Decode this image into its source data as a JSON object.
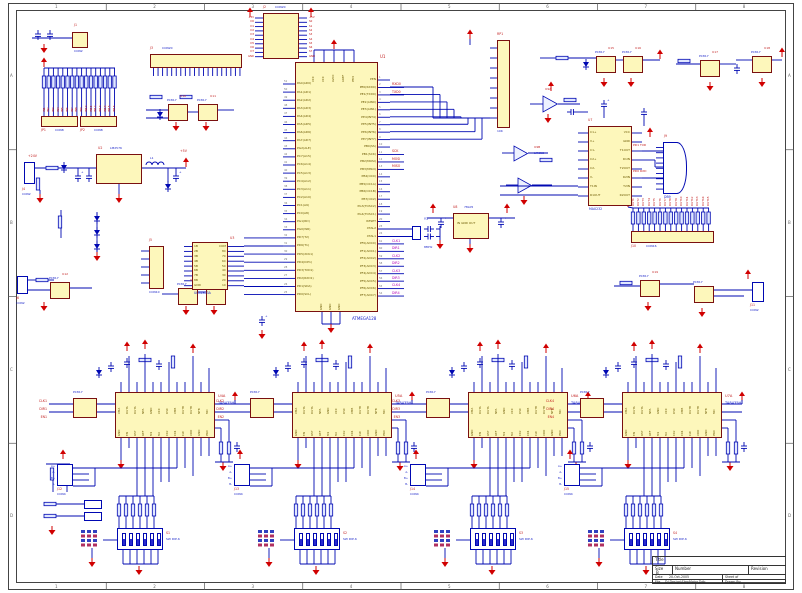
{
  "sheet": {
    "zones_top": [
      "1",
      "2",
      "3",
      "4",
      "5",
      "6",
      "7",
      "8"
    ],
    "zones_side": [
      "A",
      "B",
      "C",
      "D"
    ]
  },
  "colors": {
    "wire": "#0008b2",
    "ic_fill": "#fdf7bb",
    "ic_border": "#7a1010",
    "power": "#d00000",
    "net": "#c01818",
    "net_alt": "#b400b4",
    "part_text": "#1822c8",
    "designator": "#c22020"
  },
  "title_block": {
    "title_label": "Title",
    "size_label": "Size",
    "size_value": "B",
    "number_label": "Number",
    "revision_label": "Revision",
    "date_label": "Date",
    "date_value": "20-Oct-2005",
    "sheet_label": "Sheet of",
    "file_label": "File",
    "file_value": "D:\\Design\\StepMotor.Ddb",
    "drawn_label": "Drawn By:"
  },
  "mcu": {
    "designator": "U1",
    "part": "ATMEGA128",
    "left_pins": [
      "PA0(AD0)",
      "PA1(AD1)",
      "PA2(AD2)",
      "PA3(AD3)",
      "PA4(AD4)",
      "PA5(AD5)",
      "PA6(AD6)",
      "PA7(AD7)",
      "PG2(ALE)",
      "PC7(A15)",
      "PC6(A14)",
      "PC5(A13)",
      "PC4(A12)",
      "PC3(A11)",
      "PC2(A10)",
      "PC1(A9)",
      "PC0(A8)",
      "PG1(RD)",
      "PG0(WR)",
      "PD7(T2)",
      "PD6(T1)",
      "PD5(XCK1)",
      "PD4(ICP1)",
      "PD3(TXD1)",
      "PD2(RXD1)",
      "PD1(SDA)",
      "PD0(SCL)"
    ],
    "left_nums": [
      51,
      50,
      49,
      48,
      47,
      46,
      45,
      44,
      43,
      42,
      41,
      40,
      39,
      38,
      37,
      36,
      35,
      34,
      33,
      32,
      31,
      30,
      29,
      28,
      27,
      26,
      25
    ],
    "right_pins": [
      "PEN",
      "PE0(RXD0)",
      "PE1(TXD0)",
      "PE2(AIN0)",
      "PE3(AIN1)",
      "PE4(INT4)",
      "PE5(INT5)",
      "PE6(INT6)",
      "PE7(INT7)",
      "PB0(SS)",
      "PB1(SCK)",
      "PB2(MOSI)",
      "PB3(MISO)",
      "PB4(OC0)",
      "PB5(OC1A)",
      "PB6(OC1B)",
      "PB7(OC2)",
      "PG3(TOSC2)",
      "PG4(TOSC1)",
      "RESET",
      "XTAL2",
      "XTAL1",
      "PF0(ADC0)",
      "PF1(ADC1)",
      "PF2(ADC2)",
      "PF3(ADC3)",
      "PF4(ADC4)",
      "PF5(ADC5)",
      "PF6(ADC6)",
      "PF7(ADC7)"
    ],
    "right_nums": [
      1,
      2,
      3,
      4,
      5,
      6,
      7,
      8,
      9,
      10,
      11,
      12,
      13,
      14,
      15,
      16,
      17,
      18,
      19,
      20,
      23,
      24,
      61,
      60,
      59,
      58,
      57,
      56,
      55,
      54
    ],
    "top_pins": [
      "VCC",
      "VCC",
      "AVCC",
      "AREF",
      "PEN"
    ],
    "bottom_pins": [
      "GND",
      "GND",
      "GND"
    ],
    "right_nets": {
      "1": "RXD0",
      "2": "TXD0",
      "10": "SCK",
      "11": "MOSI",
      "12": "MISO",
      "22": "CLK1",
      "23": "DIR1",
      "24": "CLK2",
      "25": "DIR2",
      "26": "CLK3",
      "27": "DIR3",
      "28": "CLK4",
      "29": "DIR4"
    }
  },
  "power": {
    "reg": {
      "designator": "U2",
      "part": "LM2576"
    },
    "conn": {
      "designator": "J4",
      "part": "CON2"
    },
    "inductor": "L1",
    "rail5": "+5V",
    "rail24": "+24V"
  },
  "uln": {
    "designator": "U3",
    "part": "ULN2803A",
    "left_pins": [
      "1B",
      "2B",
      "3B",
      "4B",
      "5B",
      "6B",
      "7B",
      "8B",
      "GND"
    ],
    "right_pins": [
      "COM",
      "8C",
      "7C",
      "6C",
      "5C",
      "4C",
      "3C",
      "2C",
      "1C"
    ]
  },
  "reg5": {
    "designator": "U8",
    "part": "78L05",
    "pins": "IN GND OUT"
  },
  "serial": {
    "max": {
      "designator": "U7",
      "part": "MAX232",
      "pins_left": [
        "C1+",
        "V+",
        "C1-",
        "C2+",
        "C2-",
        "V-",
        "T1IN",
        "R1OUT"
      ],
      "pins_right": [
        "VCC",
        "GND",
        "T1OUT",
        "R1IN",
        "T2OUT",
        "R2IN",
        "T2IN",
        "R2OUT"
      ]
    },
    "db9": {
      "designator": "J9",
      "part": "DB9"
    },
    "net_txd": "PD1 TXD",
    "net_rxd": "PD0 RXD"
  },
  "xtal": {
    "designator": "Y1",
    "part": "8MHz"
  },
  "comparators": {
    "a": {
      "designator": "U9A",
      "part": "LM358"
    },
    "b": {
      "designator": "U9B",
      "part": "LM358"
    }
  },
  "connectors": {
    "j1": {
      "designator": "J1",
      "part": "CON2"
    },
    "j2": {
      "designator": "J2",
      "part": "CON20",
      "nets_left": [
        "+5V",
        "D0",
        "D1",
        "D2",
        "D3",
        "D4",
        "D5",
        "D6",
        "D7",
        "GND"
      ],
      "nets_right": [
        "+5V",
        "S0",
        "S1",
        "S2",
        "S3",
        "S4",
        "S5",
        "S6",
        "S7",
        "GND"
      ]
    },
    "j3": {
      "designator": "J3",
      "part": "CON20"
    },
    "jp1": {
      "designator": "JP1",
      "part": "CON8"
    },
    "jp2": {
      "designator": "JP2",
      "part": "CON8"
    },
    "isp": {
      "designator": "J5",
      "part": "CON10"
    },
    "j6": {
      "designator": "J6",
      "part": "CON2"
    },
    "j10": {
      "designator": "J10",
      "part": "CON16"
    },
    "j11": {
      "designator": "J11",
      "part": "CON2"
    }
  },
  "rp1": {
    "designator": "RP1",
    "part": "10K"
  },
  "optos": {
    "part": "PC817",
    "designators": [
      "U10",
      "U11",
      "U12",
      "U13",
      "U14",
      "U15",
      "U16",
      "U17",
      "U18",
      "U19"
    ]
  },
  "input_nets": [
    "IN1",
    "IN2",
    "IN3",
    "IN4",
    "IN5",
    "IN6",
    "IN7",
    "IN8",
    "IN9",
    "IN10",
    "IN11",
    "IN12",
    "IN13",
    "IN14",
    "IN15",
    "IN16"
  ],
  "output_nets": [
    "OUT1",
    "OUT2",
    "OUT3",
    "OUT4",
    "OUT5",
    "OUT6",
    "OUT7",
    "OUT8",
    "OUT9",
    "OUT10",
    "OUT11",
    "OUT12",
    "OUT13",
    "OUT14",
    "OUT15"
  ],
  "drivers": {
    "part": "TA8435H",
    "designators": [
      "U4A",
      "U5A",
      "U6A",
      "U7A"
    ],
    "top_pins": [
      "VMA",
      "OUTA",
      "OUTA",
      "NFA",
      "GND",
      "VCC",
      "OSC",
      "VMB",
      "OUTB",
      "OUTB",
      "NFB",
      "MO"
    ],
    "bottom_pins": [
      "GND",
      "EN",
      "RST",
      "REF",
      "M1",
      "M2",
      "CK2",
      "CK1",
      "CW",
      "VDD",
      "GND",
      "PRO"
    ],
    "nets": [
      [
        "CLK1",
        "DIR1",
        "EN1"
      ],
      [
        "CLK2",
        "DIR2",
        "EN2"
      ],
      [
        "CLK3",
        "DIR3",
        "EN3"
      ],
      [
        "CLK4",
        "DIR4",
        "EN4"
      ]
    ],
    "out_nets": [
      "A+",
      "A-",
      "B+",
      "B-"
    ],
    "opto_label": "PC817",
    "dip": {
      "part": "SW DIP-6",
      "designators": [
        "S1",
        "S2",
        "S3",
        "S4"
      ]
    },
    "conn": {
      "part": "CON4",
      "designators": [
        "J12",
        "J13",
        "J14",
        "J15"
      ]
    }
  }
}
